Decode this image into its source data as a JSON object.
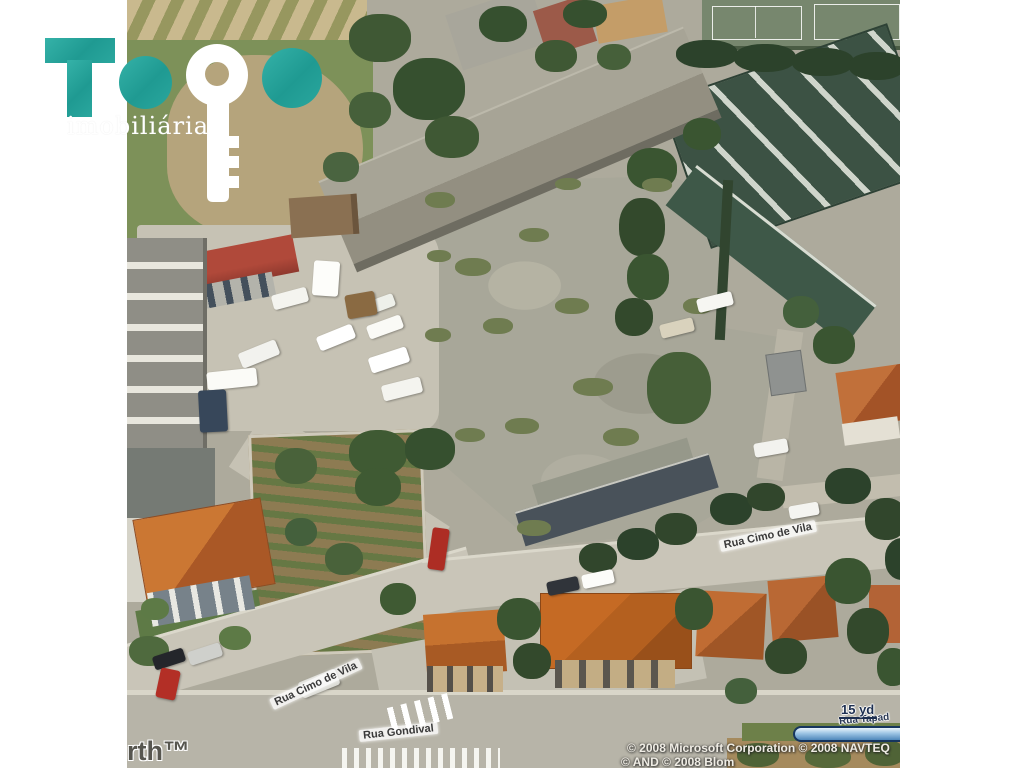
{
  "logo": {
    "brand": "TOPO",
    "tagline": "imobiliária",
    "teal": "#2aa79e",
    "key_icon_color": "#ffffff"
  },
  "map": {
    "street_labels": [
      {
        "text": "Rua Cimo de Vila"
      },
      {
        "text": "Rua Cimo de Vila"
      },
      {
        "text": "Rua Gondival"
      },
      {
        "text": "Rua Tapad"
      }
    ],
    "scale": {
      "label": "15 yd",
      "bar_color": "#4e87ba"
    },
    "watermark_partial": "rth™",
    "attribution_line1": "© 2008 Microsoft Corporation  © 2008 NAVTEQ",
    "attribution_line2": "© AND © 2008 Blom",
    "colors": {
      "concrete_lot": "#a8a799",
      "road": "#c9c5b8",
      "grass": "#7d9159",
      "green_roof": "#3c5244",
      "orange_roof": "#b4601f",
      "red_roof": "#a23f33",
      "warehouse_roof": "#a09d8f"
    },
    "vegetation": [
      [
        222,
        14,
        62,
        48,
        "#3f5834"
      ],
      [
        266,
        58,
        72,
        62,
        "#36502f"
      ],
      [
        298,
        116,
        54,
        42,
        "#3f5834"
      ],
      [
        222,
        92,
        42,
        36,
        "#46603a"
      ],
      [
        352,
        6,
        48,
        36,
        "#36502f"
      ],
      [
        408,
        40,
        42,
        32,
        "#3f5834"
      ],
      [
        436,
        0,
        44,
        28,
        "#36502f"
      ],
      [
        470,
        44,
        34,
        26,
        "#46603a"
      ],
      [
        196,
        152,
        36,
        30,
        "#4a6440"
      ],
      [
        549,
        40,
        62,
        28,
        "#2c422b"
      ],
      [
        607,
        44,
        62,
        28,
        "#2c422b"
      ],
      [
        665,
        48,
        62,
        28,
        "#2c422b"
      ],
      [
        722,
        52,
        56,
        28,
        "#2c422b"
      ],
      [
        500,
        148,
        50,
        42,
        "#3a5531"
      ],
      [
        492,
        198,
        46,
        58,
        "#33492c"
      ],
      [
        500,
        254,
        42,
        46,
        "#3a5531"
      ],
      [
        488,
        298,
        38,
        38,
        "#33492c"
      ],
      [
        520,
        352,
        64,
        72,
        "#465f38"
      ],
      [
        556,
        118,
        38,
        32,
        "#3a5531"
      ],
      [
        686,
        326,
        42,
        38,
        "#3a5531"
      ],
      [
        656,
        296,
        36,
        32,
        "#44603c"
      ],
      [
        298,
        192,
        30,
        16,
        "#6f7c50"
      ],
      [
        328,
        258,
        36,
        18,
        "#6f7c50"
      ],
      [
        356,
        318,
        30,
        16,
        "#6f7c50"
      ],
      [
        298,
        328,
        26,
        14,
        "#6f7c50"
      ],
      [
        392,
        228,
        30,
        14,
        "#6f7c50"
      ],
      [
        428,
        298,
        34,
        16,
        "#6f7c50"
      ],
      [
        446,
        378,
        40,
        18,
        "#6f7c50"
      ],
      [
        378,
        418,
        34,
        16,
        "#6f7c50"
      ],
      [
        328,
        428,
        30,
        14,
        "#6f7c50"
      ],
      [
        476,
        428,
        36,
        18,
        "#6f7c50"
      ],
      [
        556,
        298,
        30,
        16,
        "#6f7c50"
      ],
      [
        428,
        178,
        26,
        12,
        "#6f7c50"
      ],
      [
        515,
        178,
        30,
        14,
        "#6f7c50"
      ],
      [
        390,
        520,
        34,
        16,
        "#6f7c50"
      ],
      [
        300,
        250,
        24,
        12,
        "#6f7c50"
      ],
      [
        222,
        430,
        58,
        46,
        "#3f5a33"
      ],
      [
        278,
        428,
        50,
        42,
        "#36502f"
      ],
      [
        148,
        448,
        42,
        36,
        "#49623a"
      ],
      [
        228,
        468,
        46,
        38,
        "#3f5a33"
      ],
      [
        198,
        543,
        38,
        32,
        "#49623a"
      ],
      [
        253,
        583,
        36,
        32,
        "#3f5a33"
      ],
      [
        158,
        518,
        32,
        28,
        "#44603c"
      ],
      [
        452,
        543,
        38,
        30,
        "#31462c"
      ],
      [
        490,
        528,
        42,
        32,
        "#2c422b"
      ],
      [
        528,
        513,
        42,
        32,
        "#31462c"
      ],
      [
        583,
        493,
        42,
        32,
        "#2c422b"
      ],
      [
        620,
        483,
        38,
        28,
        "#31462c"
      ],
      [
        698,
        468,
        46,
        36,
        "#2c422b"
      ],
      [
        738,
        498,
        42,
        42,
        "#31462c"
      ],
      [
        758,
        538,
        36,
        42,
        "#2c422b"
      ],
      [
        370,
        598,
        44,
        42,
        "#3a5531"
      ],
      [
        386,
        643,
        38,
        36,
        "#33492c"
      ],
      [
        548,
        588,
        38,
        42,
        "#3a5531"
      ],
      [
        638,
        638,
        42,
        36,
        "#33492c"
      ],
      [
        698,
        558,
        46,
        46,
        "#3a5531"
      ],
      [
        720,
        608,
        42,
        46,
        "#33492c"
      ],
      [
        750,
        648,
        32,
        38,
        "#3a5531"
      ],
      [
        598,
        678,
        32,
        26,
        "#44603c"
      ],
      [
        610,
        743,
        42,
        24,
        "#4f6336"
      ],
      [
        678,
        746,
        46,
        22,
        "#57693a"
      ],
      [
        738,
        740,
        40,
        26,
        "#4f6336"
      ],
      [
        14,
        598,
        28,
        22,
        "#5d7a46"
      ],
      [
        92,
        626,
        32,
        24,
        "#5d7a46"
      ],
      [
        2,
        636,
        40,
        30,
        "#4f6a3e"
      ]
    ],
    "vehicles": [
      [
        112,
        346,
        40,
        16,
        "#f2f2ee",
        -22
      ],
      [
        190,
        330,
        38,
        15,
        "#ffffff",
        -22
      ],
      [
        236,
        298,
        32,
        13,
        "#eef0ea",
        -20
      ],
      [
        240,
        320,
        36,
        14,
        "#fafaf6",
        -20
      ],
      [
        242,
        352,
        40,
        16,
        "#ffffff",
        -18
      ],
      [
        255,
        381,
        40,
        16,
        "#f4f4ef",
        -14
      ],
      [
        80,
        370,
        50,
        18,
        "#fbfbf7",
        -6
      ],
      [
        72,
        390,
        28,
        42,
        "#37475a",
        -3
      ],
      [
        186,
        261,
        26,
        35,
        "#fdfdfa",
        4
      ],
      [
        219,
        293,
        30,
        24,
        "#8a6a42",
        -10
      ],
      [
        145,
        291,
        36,
        15,
        "#f4f4ef",
        -15
      ],
      [
        570,
        295,
        36,
        14,
        "#f6f6f2",
        -14
      ],
      [
        533,
        321,
        34,
        14,
        "#d9d2bd",
        -14
      ],
      [
        627,
        441,
        34,
        14,
        "#f2f2ee",
        -10
      ],
      [
        303,
        528,
        17,
        42,
        "#ad2d24",
        8
      ],
      [
        420,
        579,
        32,
        14,
        "#30343a",
        -12
      ],
      [
        455,
        572,
        32,
        14,
        "#fcfcf9",
        -12
      ],
      [
        662,
        504,
        30,
        13,
        "#f4f4f0",
        -10
      ],
      [
        26,
        652,
        32,
        14,
        "#24262b",
        -18
      ],
      [
        61,
        647,
        34,
        14,
        "#cfd0cc",
        -18
      ],
      [
        31,
        669,
        20,
        30,
        "#b32f26",
        12
      ],
      [
        172,
        675,
        40,
        17,
        "#dcdcd6",
        -22
      ]
    ]
  }
}
